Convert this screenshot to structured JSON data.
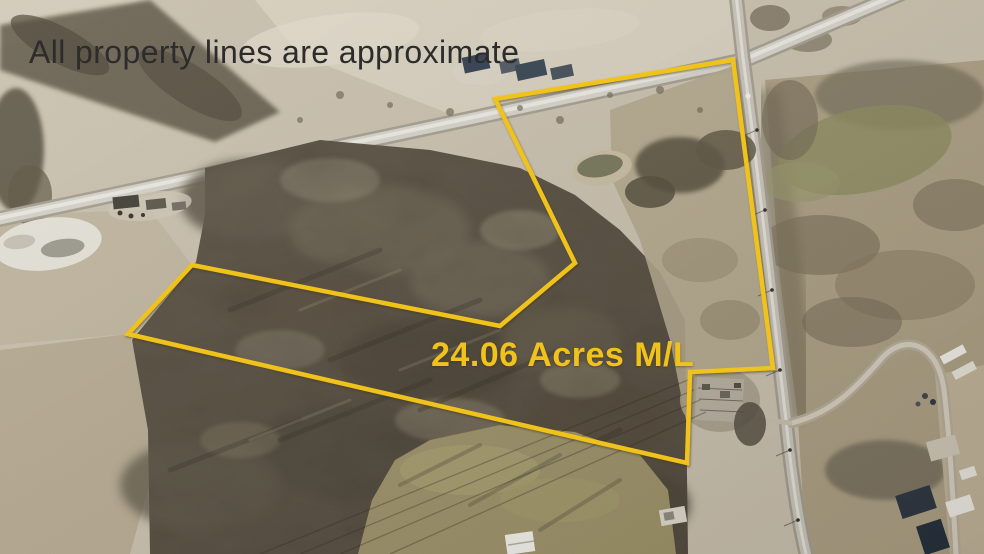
{
  "photo": {
    "description": "Aerial drone view of rural wooded acreage for sale with outlined parcel, country crossroads and farm fields",
    "disclaimer_text": "All property lines are approximate",
    "acreage_label": "24.06 Acres M/L",
    "colors": {
      "boundary_yellow": "#F0C21B",
      "disclaimer_ink": "#2C2C2C"
    }
  }
}
